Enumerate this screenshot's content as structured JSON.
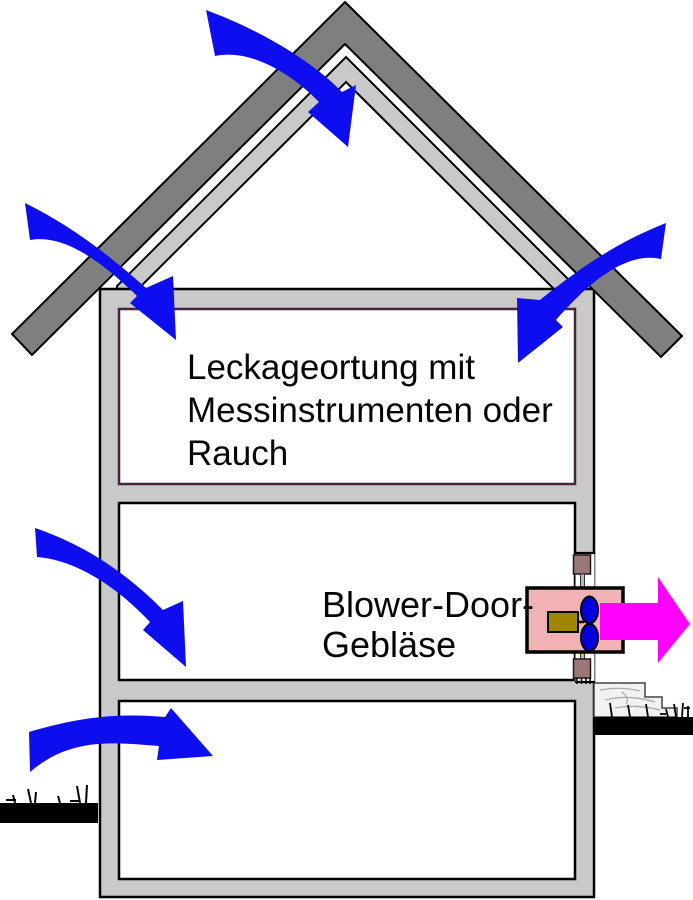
{
  "diagram": {
    "attic_label": {
      "lines": [
        "Leckageortung mit",
        "Messinstrumenten oder",
        "Rauch"
      ]
    },
    "fan_label": {
      "lines": [
        "Blower-Door-",
        "Gebläse"
      ]
    },
    "colors": {
      "arrow_blue": "#0d0df0",
      "arrow_magenta": "#ff00ff",
      "roof_dark_gray": "#7f7f7f",
      "structure_gray": "#c9c9c9",
      "room_white": "#ffffff",
      "attic_border_maroon": "#44253c",
      "outline_black": "#000000",
      "fan_box_pink": "#f0b2b2",
      "motor_olive": "#a08500",
      "fan_blade_blue": "#0000dd",
      "door_frame_mauve": "#9a7878",
      "ground_black": "#000000",
      "rubble_light": "#f2f2f2"
    },
    "icons": {
      "air_infiltration": "curved-blue-arrow",
      "air_exhaust": "straight-magenta-arrow"
    }
  }
}
